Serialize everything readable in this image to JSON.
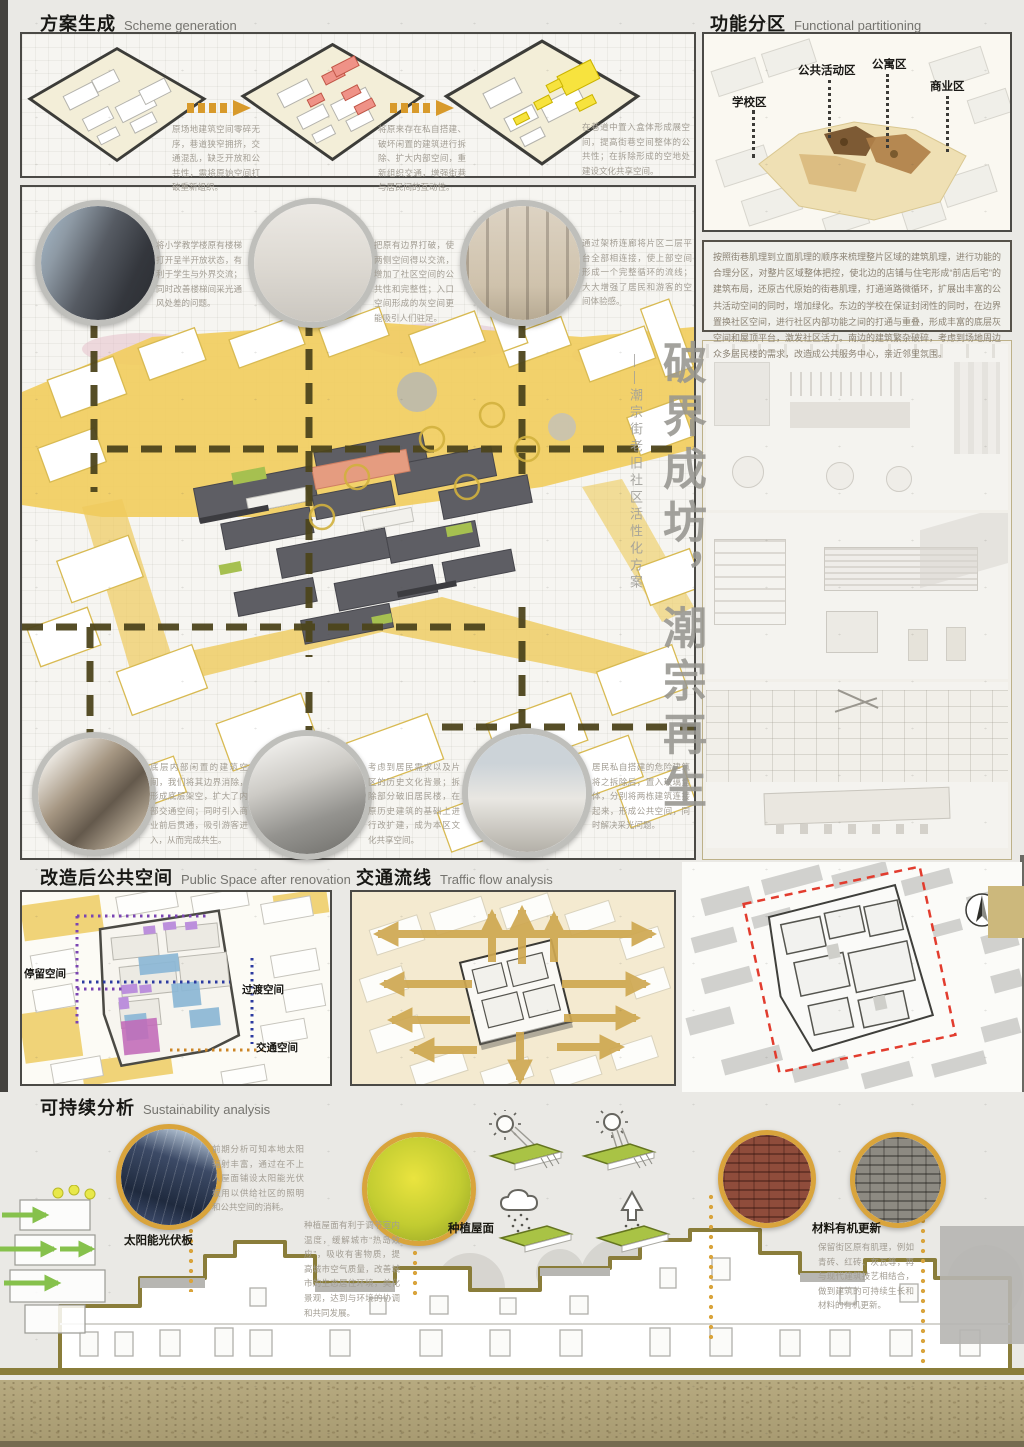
{
  "board_title": {
    "main": "破界成坊，潮宗再生",
    "sub": "——潮宗街老旧社区活性化方案"
  },
  "scheme": {
    "zh": "方案生成",
    "en": "Scheme generation",
    "steps": [
      {
        "caption": "原场地建筑空间零碎无序，巷道狭窄拥挤，交通混乱，缺乏开放和公共性，需将原始空间打破重新组织。"
      },
      {
        "caption": "将原来存在私自搭建、破坏闲置的建筑进行拆除、扩大内部空间，重新组织交通，增强街巷与居民间的互动性。"
      },
      {
        "caption": "在巷道中置入盒体形成展空间，提高街巷空间整体的公共性；在拆除形成的空地处建设文化共享空间。"
      }
    ]
  },
  "partition": {
    "zh": "功能分区",
    "en": "Functional partitioning",
    "zones": [
      "学校区",
      "公共活动区",
      "公寓区",
      "商业区"
    ],
    "paragraph": "按照街巷肌理到立面肌理的顺序来梳理整片区域的建筑肌理，进行功能的合理分区，对整片区域整体把控，使北边的店铺与住宅形成“前店后宅”的建筑布局，还原古代原始的街巷肌理，打通道路微循环，扩展出丰富的公共活动空间的同时，增加绿化。东边的学校在保证封闭性的同时，在边界置换社区空间，进行社区内部功能之间的打通与重叠，形成丰富的底层灰空间和屋顶平台，激发社区活力。南边的建筑繁杂破碎，考虑到场地周边众多居民楼的需求，改造成公共服务中心，亲近邻里氛围。"
  },
  "circles": {
    "top": [
      {
        "caption": "将小学教学楼原有楼梯打开呈半开放状态，有利于学生与外界交流；同时改善楼梯间采光通风处差的问题。"
      },
      {
        "caption": "把原有边界打破，使两侧空间得以交流，增加了社区空间的公共性和完整性；入口空间形成的灰空间更能吸引人们驻足。"
      },
      {
        "caption": "通过架桥连廊将片区二层平台全部相连接，使上部空间形成一个完整循环的流线；大大增强了居民和游客的空间体验感。"
      }
    ],
    "bottom": [
      {
        "caption": "底层内部闲置的建筑空间，我们将其边界消除，形成底层架空，扩大了内部交通空间；同时引入商业前后贯通，吸引游客进入，从而完成共生。"
      },
      {
        "caption": "考虑到居民需求以及片区的历史文化背景；拆除部分破旧居民楼，在原历史建筑的基础上进行改扩建，成为本区文化共享空间。"
      },
      {
        "caption": "居民私自搭建的危险建筑将之拆除后，置入玻璃盒体，分别将两栋建筑连接起来，形成公共空间，同时解决采光问题。"
      }
    ]
  },
  "public_space": {
    "zh": "改造后公共空间",
    "en": "Public Space after renovation",
    "labels": [
      "停留空间",
      "过渡空间",
      "交通空间"
    ]
  },
  "traffic": {
    "zh": "交通流线",
    "en": "Traffic flow analysis"
  },
  "sustainability": {
    "zh": "可持续分析",
    "en": "Sustainability analysis",
    "solar": {
      "label": "太阳能光伏板",
      "caption": "前期分析可知本地太阳辐射丰富，通过在不上人屋面铺设太阳能光伏板用以供给社区的照明和公共空间的消耗。"
    },
    "green_roof": {
      "label": "种植屋面",
      "caption": "种植屋面有利于调节室内温度，缓解城市“热岛效应”，吸收有害物质，提高城市空气质量，改善城市的生态居住环境，美化景观，达到与环境的协调和共同发展。"
    },
    "material": {
      "label": "材料有机更新",
      "caption": "保留街区原有肌理，例如青砖、红砖、灰瓦等，再与现代建筑技艺相结合，做到建筑的可持续生长和材料的有机更新。"
    }
  },
  "colors": {
    "accent_gold": "#d9a43c",
    "masterplan_yellow": "#f1cd5f",
    "dash_olive": "#4d451c",
    "traffic_arrow": "#cfa851",
    "footer_tan": "#b0a47a",
    "red_dash": "#e23c2e"
  }
}
